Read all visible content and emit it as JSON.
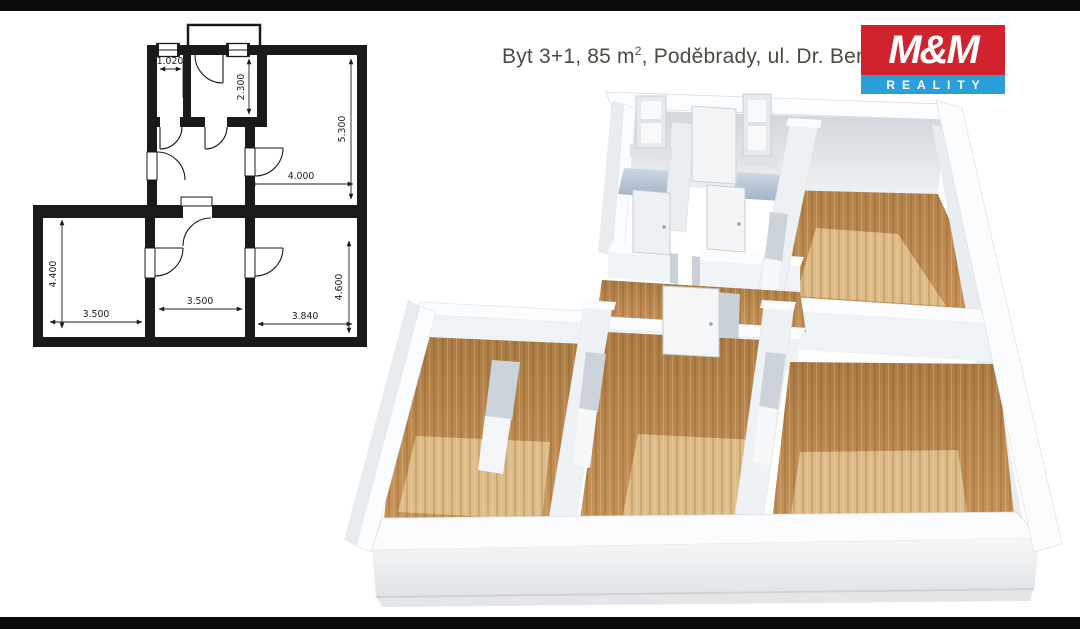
{
  "page": {
    "background": "#ffffff",
    "top_bar_color": "#0b0b0b",
    "bottom_bar_color": "#0b0b0b"
  },
  "header": {
    "title_before_sup": "Byt 3+1, 85 m",
    "title_sup": "2",
    "title_after_sup": ", Poděbrady, ul. Dr. Beneše",
    "title_color": "#4b4b43"
  },
  "logo": {
    "line1": "M&M",
    "line2": "REALITY",
    "red": "#d1232d",
    "blue": "#2c9fd8",
    "text_color": "#ffffff"
  },
  "floorplan_2d": {
    "wall_color": "#1a1a1a",
    "line_color": "#1c1c1c",
    "dimensions": {
      "room_a_width": "1.020",
      "room_b_height": "2.300",
      "living_height": "5.300",
      "living_width": "4.000",
      "room_c_height": "4.400",
      "room_c_width": "3.500",
      "room_d_width": "3.500",
      "room_e_width": "3.840",
      "room_e_height": "4.600"
    }
  },
  "floorplan_3d": {
    "wall_top": "#fbfcfd",
    "wall_face": "#eef1f3",
    "wall_shade": "#dde2e7",
    "floor_wood": "#c18b53",
    "floor_wood_dark": "#a87a42",
    "floor_wood_light": "#e3c492",
    "bath_floor": "#c6d1dd",
    "bath_floor_dark": "#a5b5c4",
    "door_panel": "#f3f5f7",
    "jamb_gray": "#c9d0d7"
  }
}
